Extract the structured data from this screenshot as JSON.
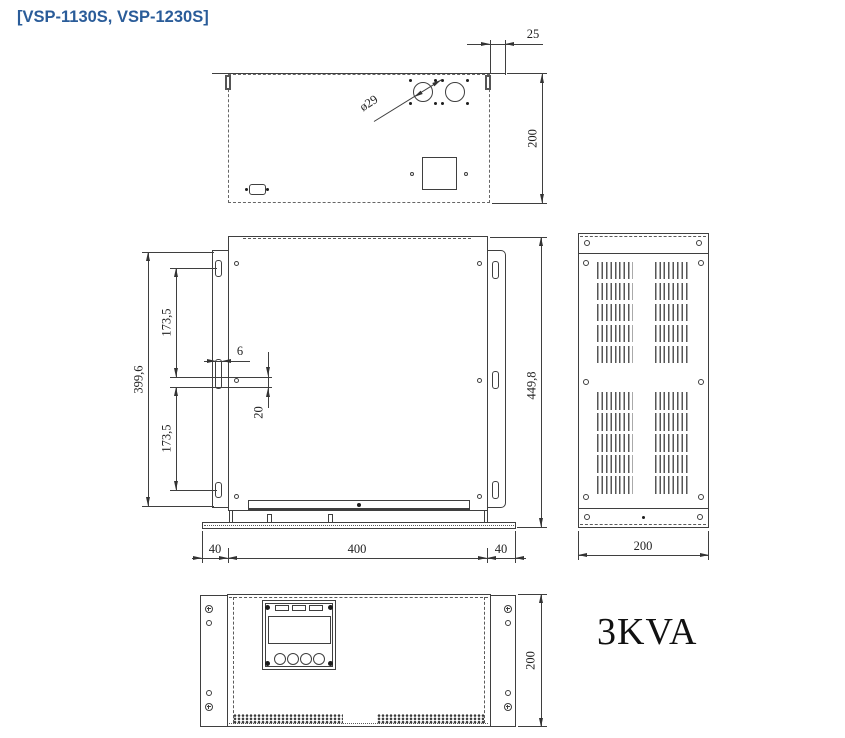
{
  "title": "[VSP-1130S, VSP-1230S]",
  "model": "3KVA",
  "colors": {
    "line": "#3f3f3f",
    "accent": "#2a5c99"
  },
  "dims": {
    "top_overhang": "25",
    "top_depth": "200",
    "top_hole_dia": "ø29",
    "front_mount_height": "399,6",
    "front_pitch_upper": "173,5",
    "front_pitch_lower": "173,5",
    "front_slot_w": "6",
    "front_slot_h": "20",
    "front_total_height": "449,8",
    "base_left": "40",
    "base_center": "400",
    "base_right": "40",
    "side_depth": "200",
    "front_face_height": "200"
  }
}
